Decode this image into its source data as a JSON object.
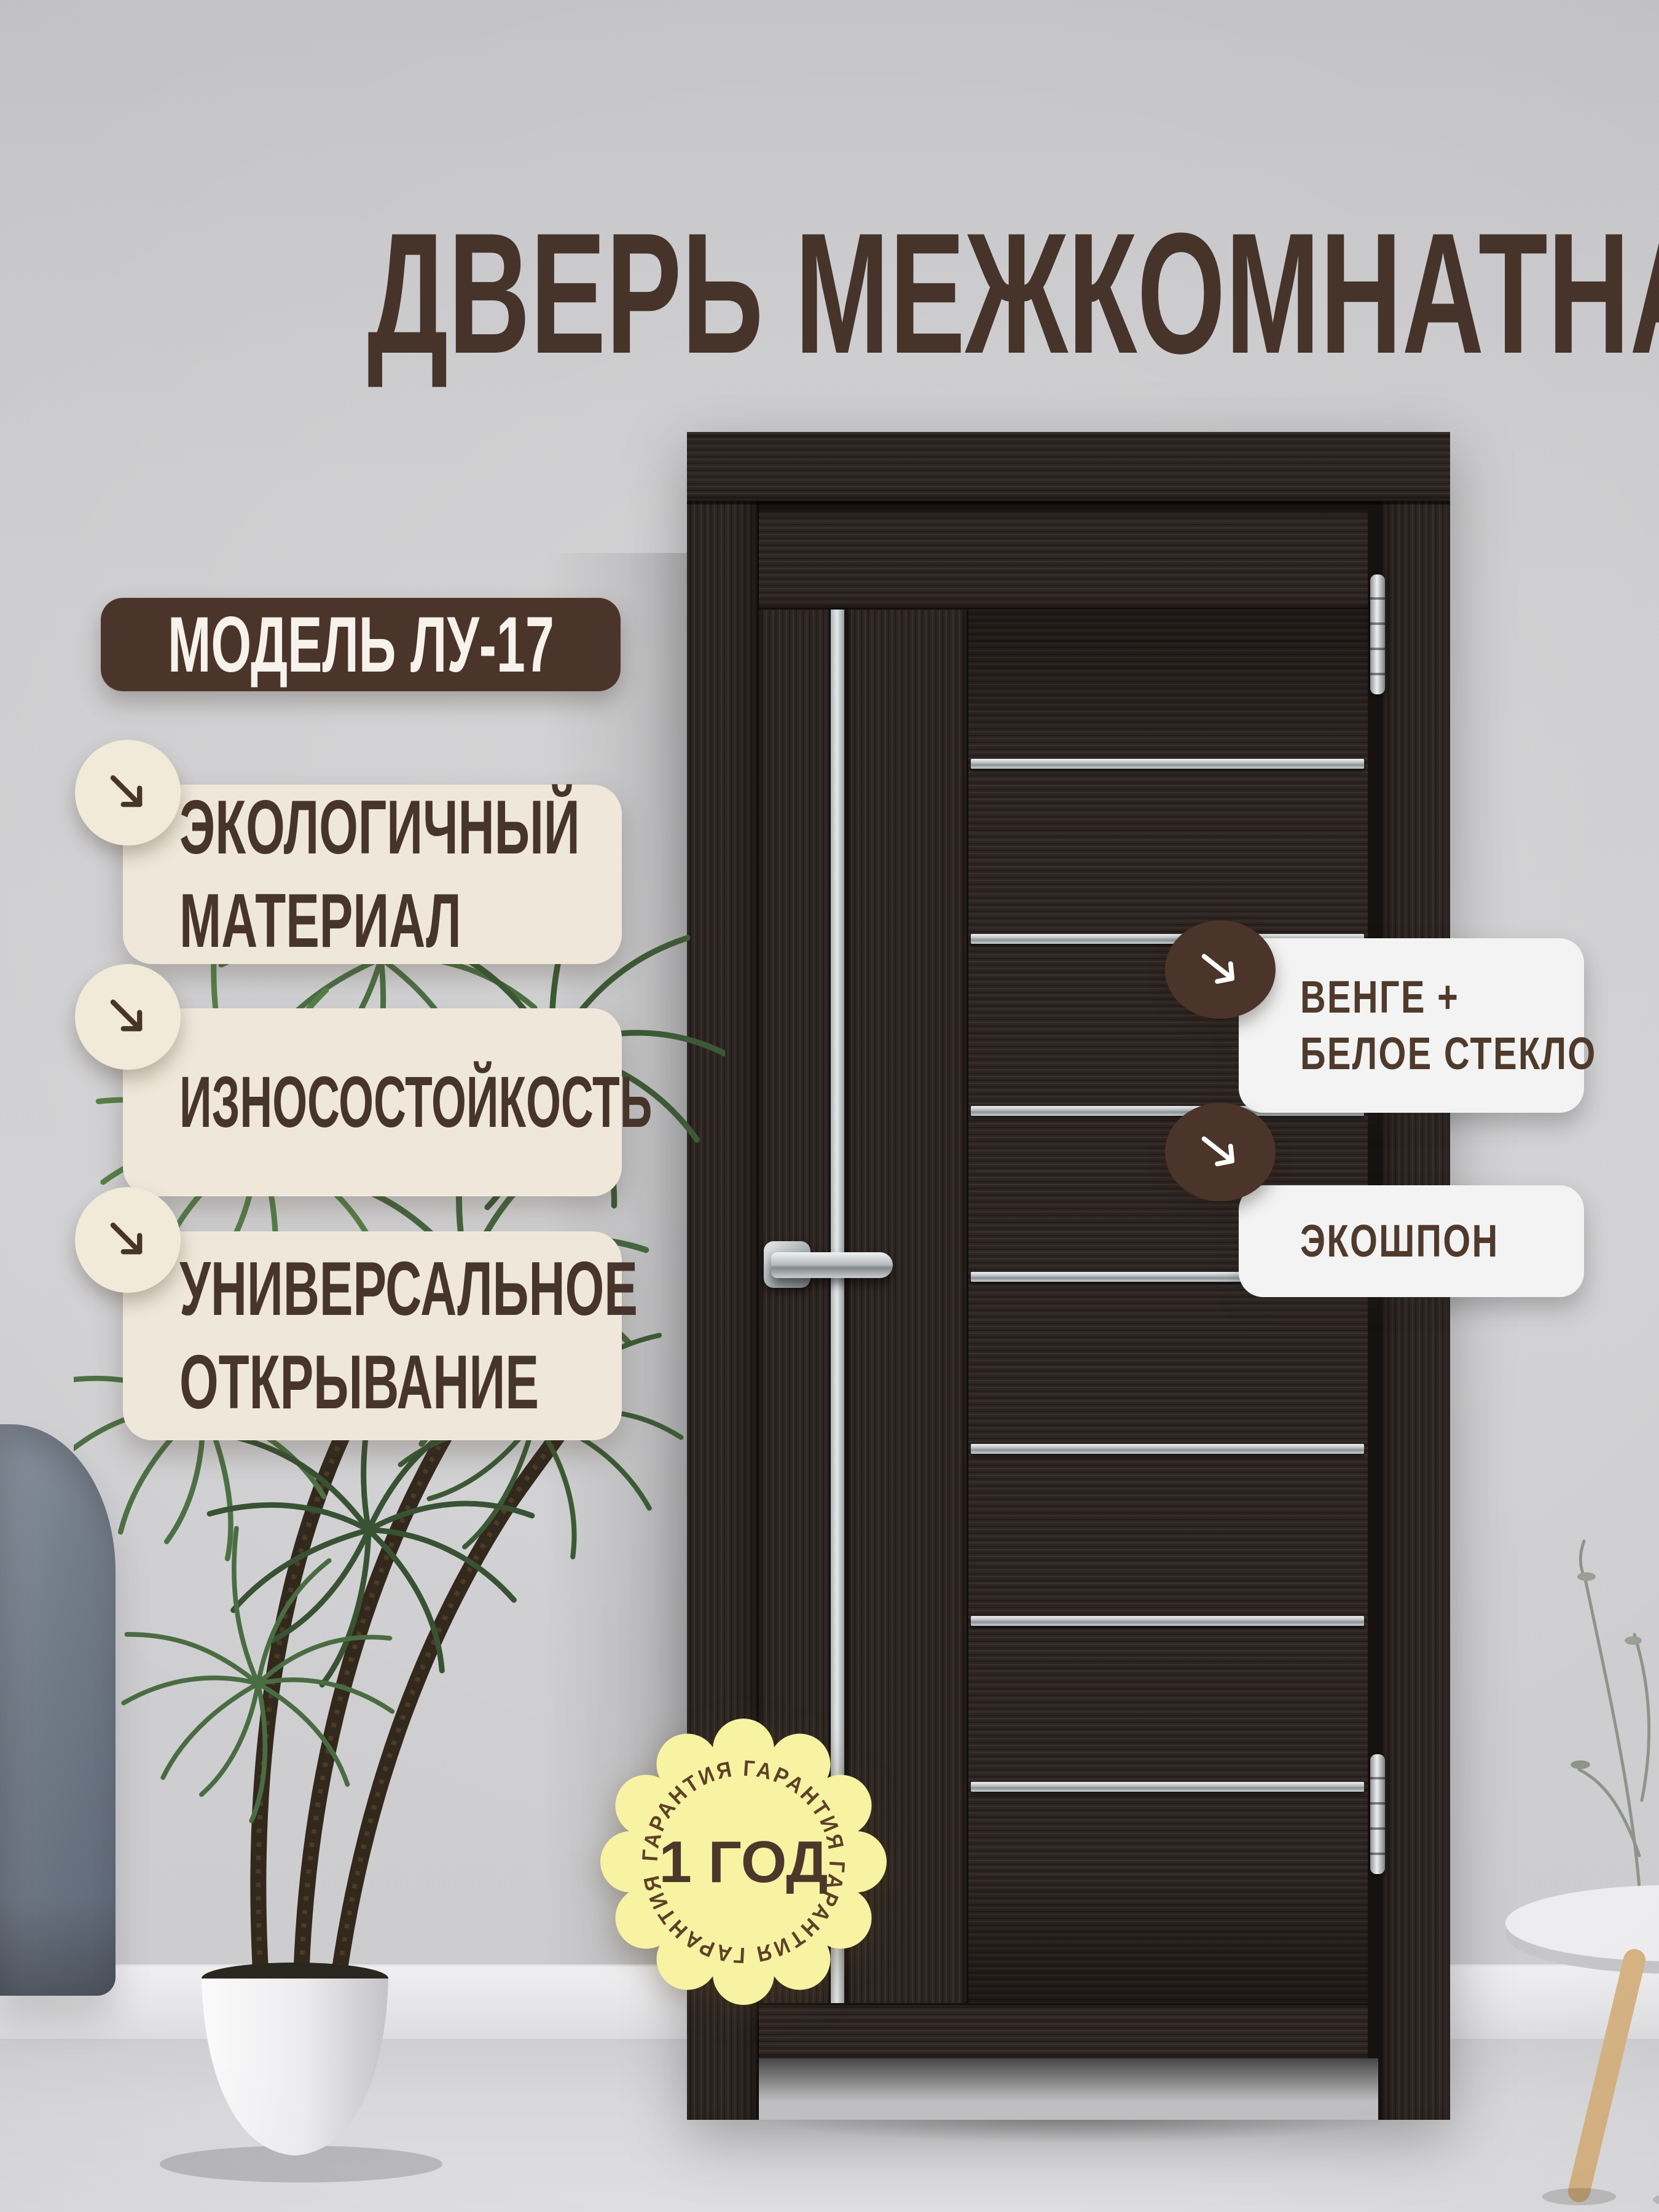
{
  "header": {
    "title": "ДВЕРЬ МЕЖКОМНАТНАЯ"
  },
  "model_badge": {
    "label": "МОДЕЛЬ ЛУ-17"
  },
  "features": [
    {
      "line1": "ЭКОЛОГИЧНЫЙ",
      "line2": "МАТЕРИАЛ"
    },
    {
      "line1": "ИЗНОСОСТОЙКОСТЬ"
    },
    {
      "line1": "УНИВЕРСАЛЬНОЕ",
      "line2": "ОТКРЫВАНИЕ"
    }
  ],
  "callouts": [
    {
      "line1": "ВЕНГЕ +",
      "line2": "БЕЛОЕ СТЕКЛО"
    },
    {
      "line1": "ЭКОШПОН"
    }
  ],
  "guarantee_badge": {
    "center_text": "1 ГОД",
    "ring_text": "ГАРАНТИЯ  ГАРАНТИЯ  ГАРАНТИЯ  ГАРАНТИЯ"
  },
  "colors": {
    "accent_brown": "#47342a",
    "badge_brown": "#4b352b",
    "cream": "#efe8da",
    "card_white": "#f3f3f3",
    "guarantee_yellow": "#f8f2a3",
    "door_wenge": "#2e2522",
    "wall_gray": "#cccccf"
  }
}
